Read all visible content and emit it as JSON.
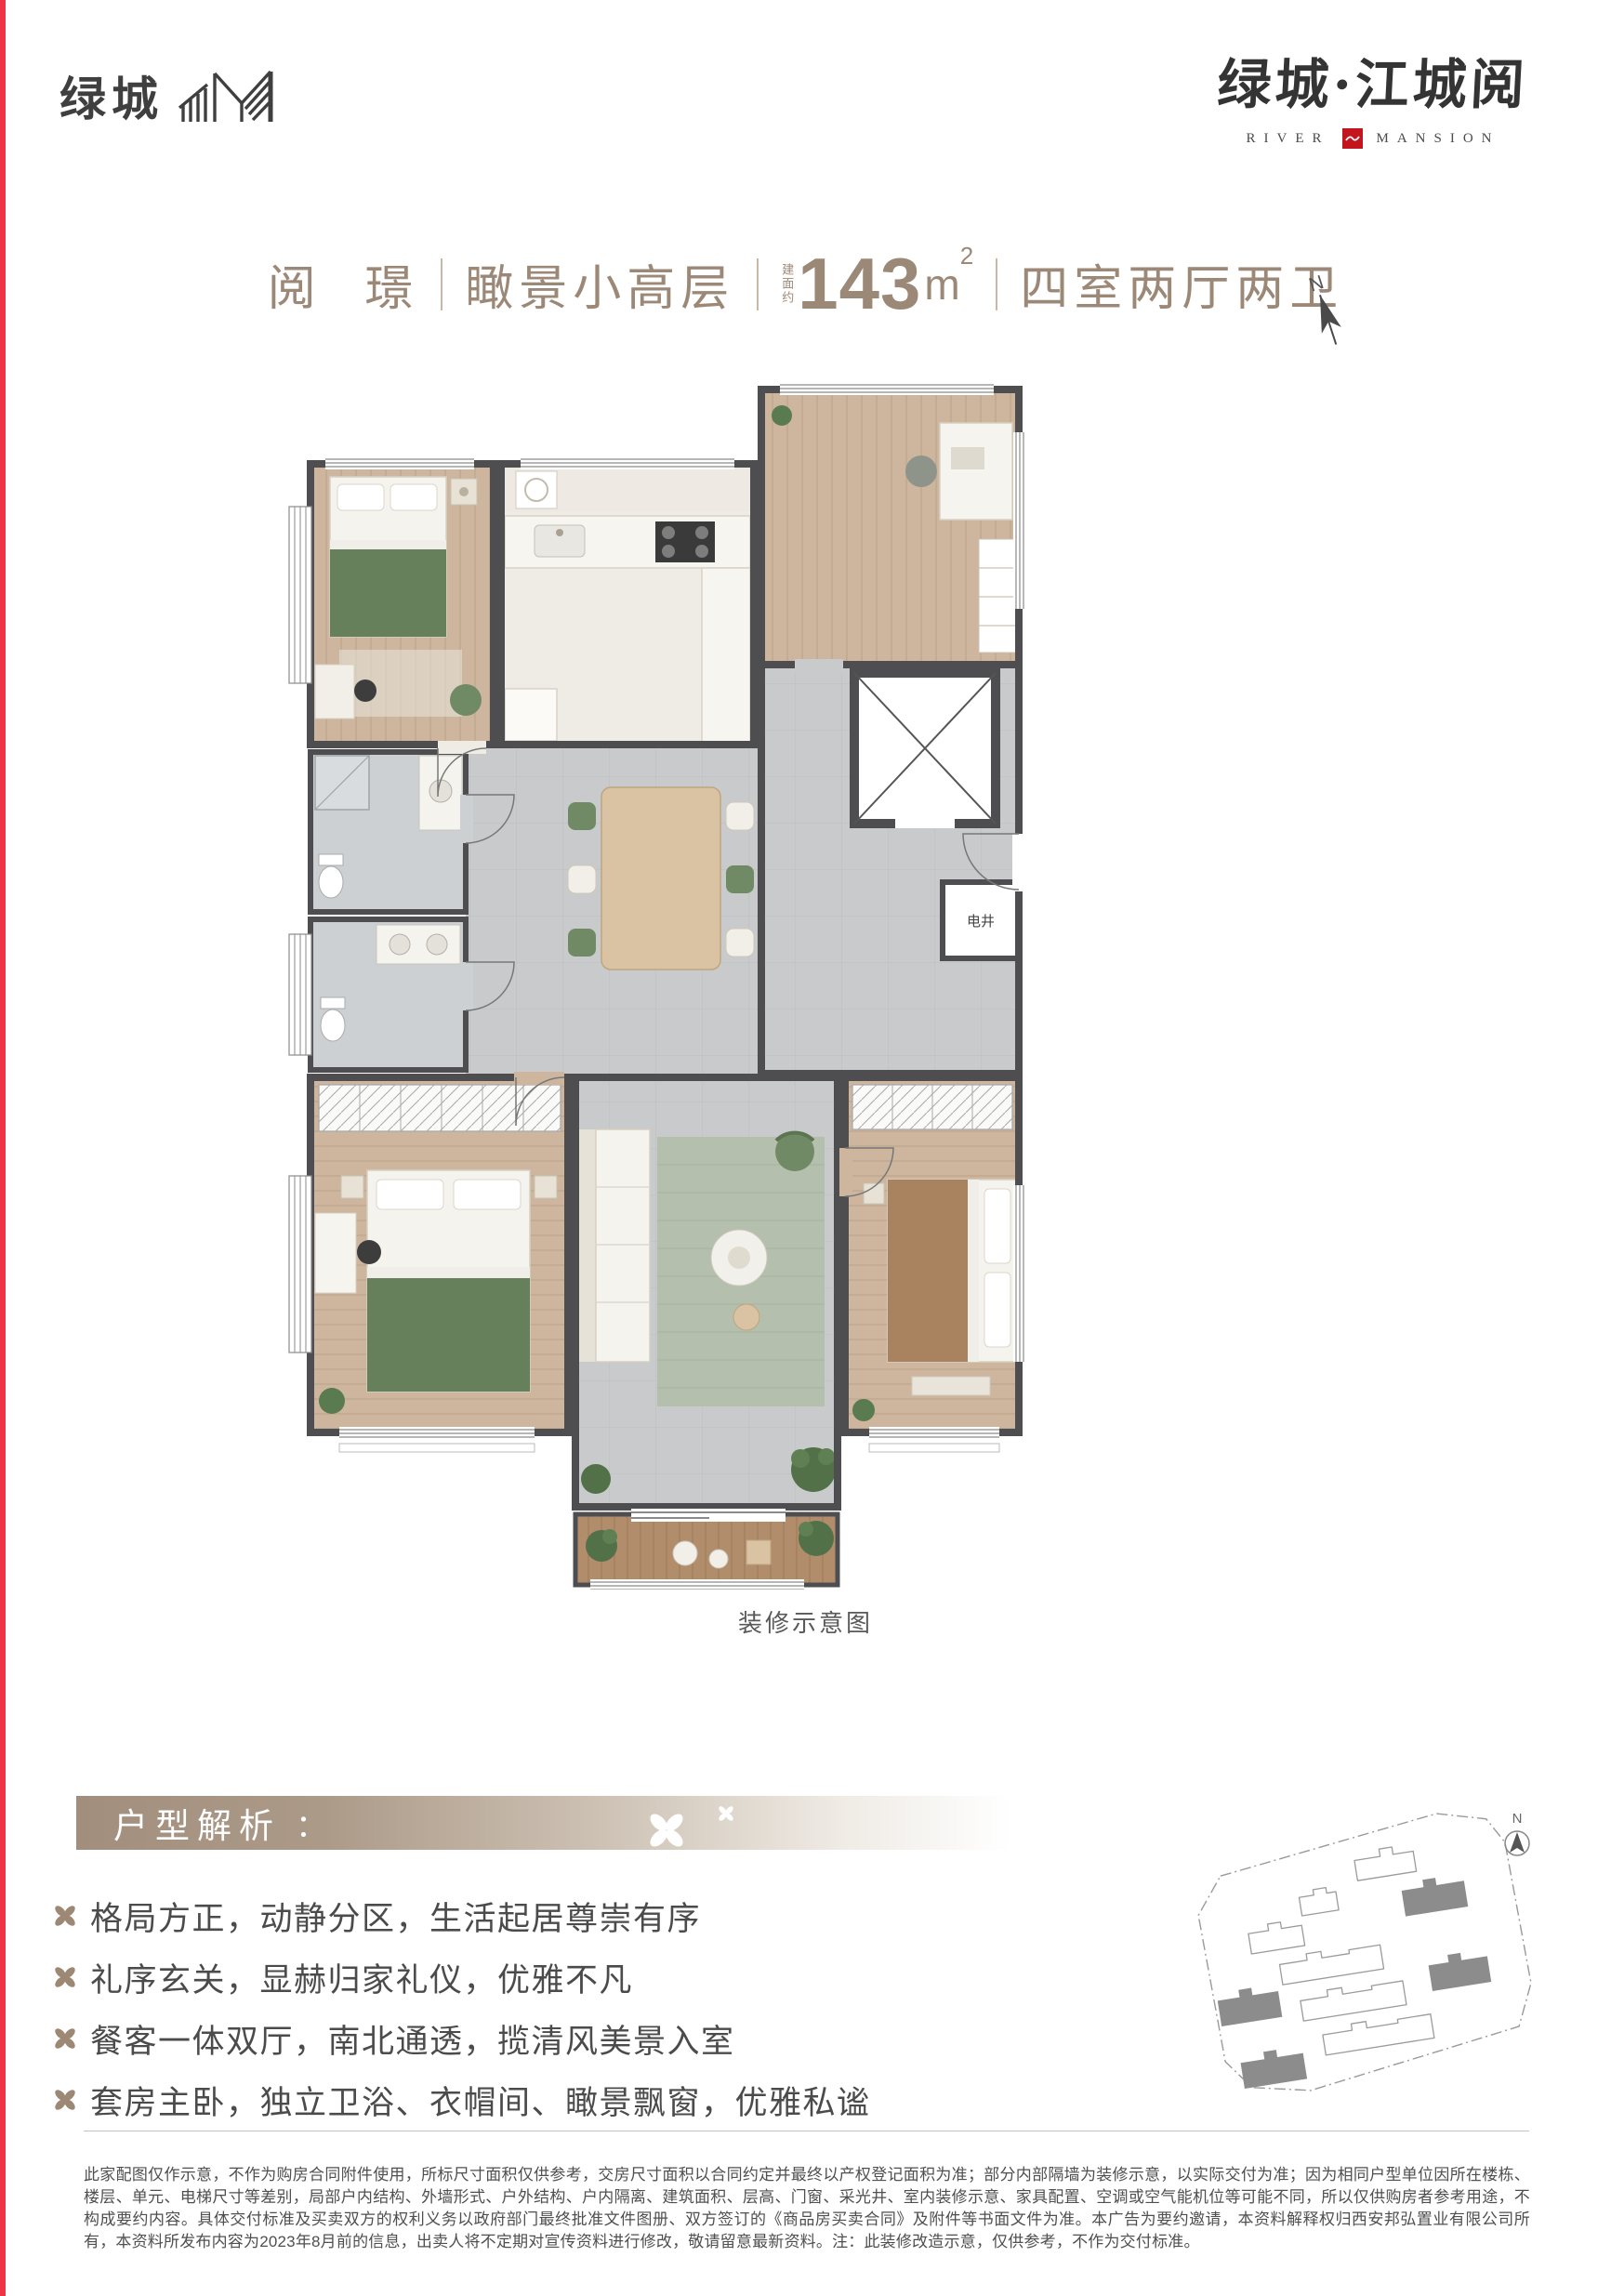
{
  "brand": {
    "logo_text": "绿城",
    "logo_icon": "greentown-mountain-icon",
    "project_name": "绿城·江城阅",
    "river": "RIVER",
    "mansion": "MANSION",
    "seal_icon": "red-seal-wave-icon"
  },
  "title": {
    "name": "阅 璟",
    "type": "瞰景小高层",
    "area_prefix": "建面约",
    "area_value": "143",
    "area_unit": "m",
    "area_sup": "2",
    "rooms": "四室两厅两卫"
  },
  "floorplan": {
    "caption": "装修示意图",
    "shaft_label": "电井",
    "compass_label": "N"
  },
  "siteplan": {
    "compass_label": "N"
  },
  "analysis": {
    "heading": "户型解析",
    "colon": "：",
    "bullets": [
      "格局方正，动静分区，生活起居尊崇有序",
      "礼序玄关，显赫归家礼仪，优雅不凡",
      "餐客一体双厅，南北通透，揽清风美景入室",
      "套房主卧，独立卫浴、衣帽间、瞰景飘窗，优雅私谧"
    ]
  },
  "disclaimer": {
    "text": "此家配图仅作示意，不作为购房合同附件使用，所标尺寸面积仅供参考，交房尺寸面积以合同约定并最终以产权登记面积为准；部分内部隔墙为装修示意，以实际交付为准；因为相同户型单位因所在楼栋、楼层、单元、电梯尺寸等差别，局部户内结构、外墙形式、户外结构、户内隔离、建筑面积、层高、门窗、采光井、室内装修示意、家具配置、空调或空气能机位等可能不同，所以仅供购房者参考用途，不构成要约内容。具体交付标准及买卖双方的权利义务以政府部门最终批准文件图册、双方签订的《商品房买卖合同》及附件等书面文件为准。本广告为要约邀请，本资料解释权归西安邦弘置业有限公司所有，本资料所发布内容为2023年8月前的信息，出卖人将不定期对宣传资料进行修改，敬请留意最新资料。注：此装修改造示意，仅供参考，不作为交付标准。"
  },
  "colors": {
    "accent_red": "#ed3545",
    "seal_red": "#c2151d",
    "brand_dark": "#3f3f3f",
    "title_taupe": "#9c8877",
    "banner_taupe": "#a28e7c",
    "clover_taupe": "#9c8874",
    "body_text": "#4b4b4b",
    "wall_gray": "#4e4e50",
    "wood_floor": "#cdb69d",
    "tile_floor": "#c8cacb",
    "deck_wood": "#b18d6c",
    "plant_green": "#5a7a50",
    "blanket_green": "#65805a",
    "blanket_brown": "#a9825f"
  }
}
